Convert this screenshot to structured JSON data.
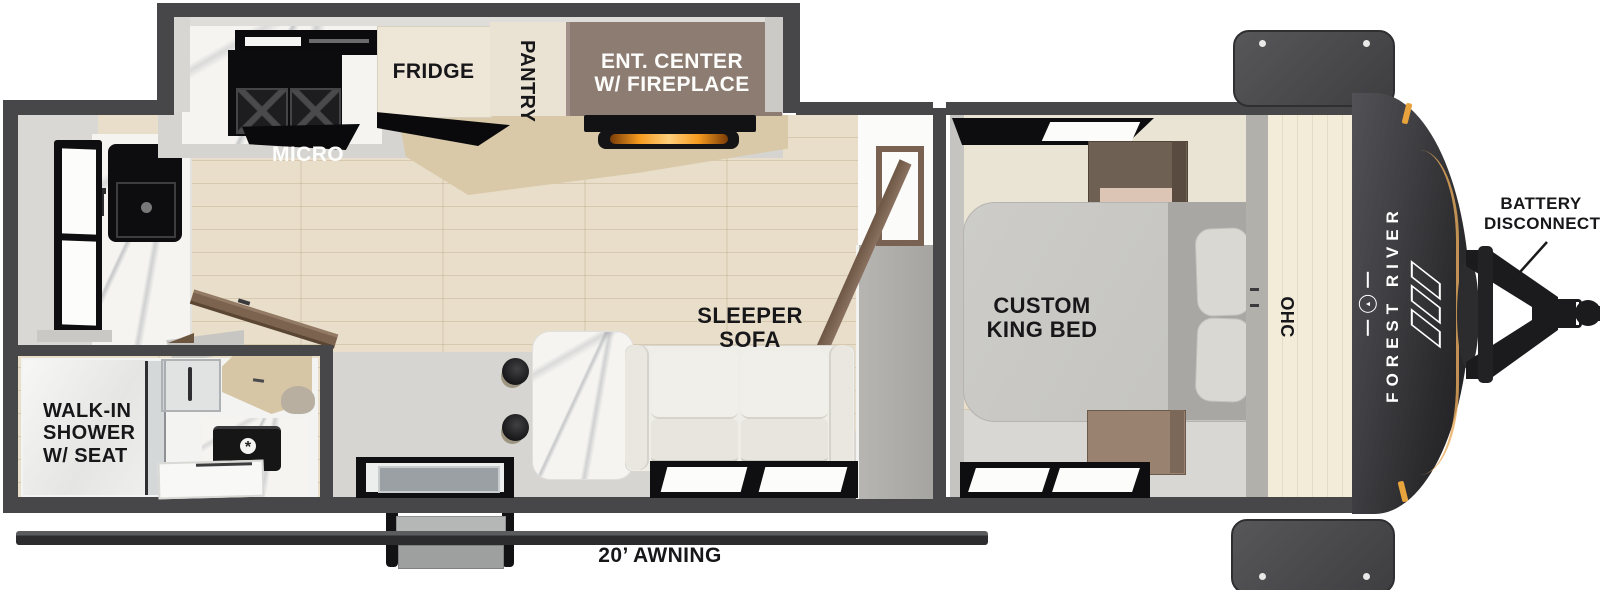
{
  "floorplan": {
    "brand": "FOREST RIVER",
    "labels": {
      "micro": "MICRO",
      "fridge": "FRIDGE",
      "pantry": "PANTRY",
      "ent_center": [
        "ENT. CENTER",
        "W/ FIREPLACE"
      ],
      "sleeper_sofa": [
        "SLEEPER",
        "SOFA"
      ],
      "custom_king_bed": [
        "CUSTOM",
        "KING BED"
      ],
      "ohc": "OHC",
      "walk_in_shower": [
        "WALK-IN",
        "SHOWER",
        "W/ SEAT"
      ],
      "awning": "20’ AWNING",
      "battery_disconnect": [
        "BATTERY",
        "DISCONNECT"
      ]
    },
    "icons": {
      "tree": "▲",
      "drain": "*"
    },
    "colors": {
      "wall": "#47474a",
      "floor_wood": "#e8deca",
      "floor_gray": "#d6d5d1",
      "ent_center_box": "#8d7c72",
      "cream_cabinet": "#eee7d8",
      "fireplace_glow": "#f59a1f",
      "marker_light": "#e8a33d",
      "front_cap": "#2b2b2e",
      "bed": "#c9c8c4",
      "cabinet_brown": "#6f6054"
    }
  }
}
